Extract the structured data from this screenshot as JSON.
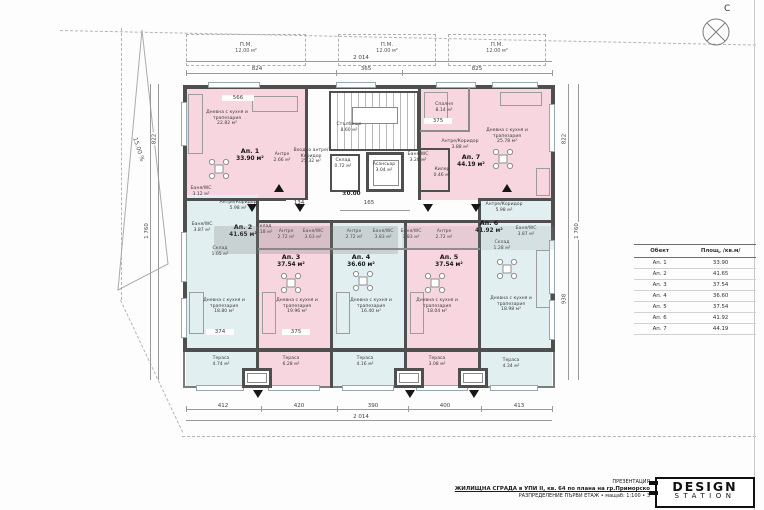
{
  "sheet": {
    "compass_label": "С"
  },
  "plan": {
    "level_label": "±0.00",
    "slope_label": "15.00 %",
    "parking": [
      {
        "label": "П.М.",
        "area": "12.00 м²"
      },
      {
        "label": "П.М.",
        "area": "12.00 м²"
      },
      {
        "label": "П.М.",
        "area": "12.00 м²"
      }
    ],
    "core": {
      "stair_name": "Стълбище",
      "stair_area": "8.60 м²",
      "elevator_name": "Асансьор",
      "elevator_area": "3.04 м²",
      "storage_name": "Склад",
      "storage_area": "0.72 м²",
      "entry_name": "Входно антре/ Коридор",
      "entry_area": "25.32 м²"
    },
    "apartments": [
      {
        "label": "Ап. 1",
        "area": "33.90 м²",
        "rooms": [
          {
            "name": "Дневна с кухня и трапезария",
            "area": "22.82 м²"
          },
          {
            "name": "Антре",
            "area": "2.66 м²"
          },
          {
            "name": "Баня/WC",
            "area": "3.12 м²"
          }
        ]
      },
      {
        "label": "Ап. 2",
        "area": "41.65 м²",
        "rooms": [
          {
            "name": "Антре/Коридор",
            "area": "5.98 м²"
          },
          {
            "name": "Баня/WC",
            "area": "3.87 м²"
          },
          {
            "name": "Склад",
            "area": "1.05 м²"
          },
          {
            "name": "Дневна с кухня и трапезария",
            "area": "18.80 м²"
          },
          {
            "name": "Тераса",
            "area": "4.74 м²"
          }
        ]
      },
      {
        "label": "Ап. 3",
        "area": "37.54 м²",
        "rooms": [
          {
            "name": "Склад",
            "area": "1.18 м²"
          },
          {
            "name": "Антре",
            "area": "2.72 м²"
          },
          {
            "name": "Баня/WC",
            "area": "3.63 м²"
          },
          {
            "name": "Дневна с кухня и трапезария",
            "area": "19.96 м²"
          },
          {
            "name": "Тераса",
            "area": "6.28 м²"
          }
        ]
      },
      {
        "label": "Ап. 4",
        "area": "36.60 м²",
        "rooms": [
          {
            "name": "Антре",
            "area": "2.72 м²"
          },
          {
            "name": "Баня/WC",
            "area": "3.83 м²"
          },
          {
            "name": "Дневна с кухня и трапезария",
            "area": "16.40 м²"
          },
          {
            "name": "Тераса",
            "area": "4.16 м²"
          }
        ]
      },
      {
        "label": "Ап. 5",
        "area": "37.54 м²",
        "rooms": [
          {
            "name": "Баня/WC",
            "area": "3.83 м²"
          },
          {
            "name": "Антре",
            "area": "2.72 м²"
          },
          {
            "name": "Дневна с кухня и трапезария",
            "area": "18.04 м²"
          },
          {
            "name": "Тераса",
            "area": "3.08 м²"
          }
        ]
      },
      {
        "label": "Ап. 6",
        "area": "41.92 м²",
        "rooms": [
          {
            "name": "Антре/Коридор",
            "area": "5.98 м²"
          },
          {
            "name": "Баня/WC",
            "area": "3.87 м²"
          },
          {
            "name": "Склад",
            "area": "1.28 м²"
          },
          {
            "name": "Дневна с кухня и трапезария",
            "area": "18.98 м²"
          },
          {
            "name": "Тераса",
            "area": "4.34 м²"
          }
        ]
      },
      {
        "label": "Ап. 7",
        "area": "44.19 м²",
        "rooms": [
          {
            "name": "Спалня",
            "area": "8.14 м²"
          },
          {
            "name": "Антре/Коридор",
            "area": "3.88 м²"
          },
          {
            "name": "Дневна с кухня и трапезария",
            "area": "25.78 м²"
          },
          {
            "name": "Баня/WC",
            "area": "3.20 м²"
          },
          {
            "name": "Килер",
            "area": "0.46 м²"
          }
        ]
      }
    ],
    "dimensions": {
      "top_total": "2 014",
      "top_segments": [
        "824",
        "365",
        "825"
      ],
      "bottom_segments": [
        "412",
        "420",
        "390",
        "400",
        "413"
      ],
      "bottom_total": "2 014",
      "left_upper": "822",
      "left_total": "1 760",
      "right_upper": "822",
      "right_lower": "938",
      "right_total": "1 760",
      "corridor_width": "165",
      "corridor_inner": "134",
      "inner": [
        "566",
        "375",
        "374",
        "375"
      ]
    }
  },
  "legend_table": {
    "headers": [
      "Обект",
      "Площ, /кв.м/"
    ],
    "rows": [
      [
        "Ап. 1",
        "33.90"
      ],
      [
        "Ап. 2",
        "41.65"
      ],
      [
        "Ап. 3",
        "37.54"
      ],
      [
        "Ап. 4",
        "36.60"
      ],
      [
        "Ап. 5",
        "37.54"
      ],
      [
        "Ап. 6",
        "41.92"
      ],
      [
        "Ап. 7",
        "44.19"
      ]
    ]
  },
  "titleblock": {
    "kicker": "ПРЕЗЕНТАЦИЯ",
    "line1": "ЖИЛИЩНА СГРАДА в УПИ II, кв. 64 по плана на гр.Приморско",
    "line2": "РАЗПРЕДЕЛЕНИЕ ПЪРВИ ЕТАЖ • мащаб: 1:100 • 3",
    "logo_top": "DESIGN",
    "logo_bottom": "STATION"
  }
}
